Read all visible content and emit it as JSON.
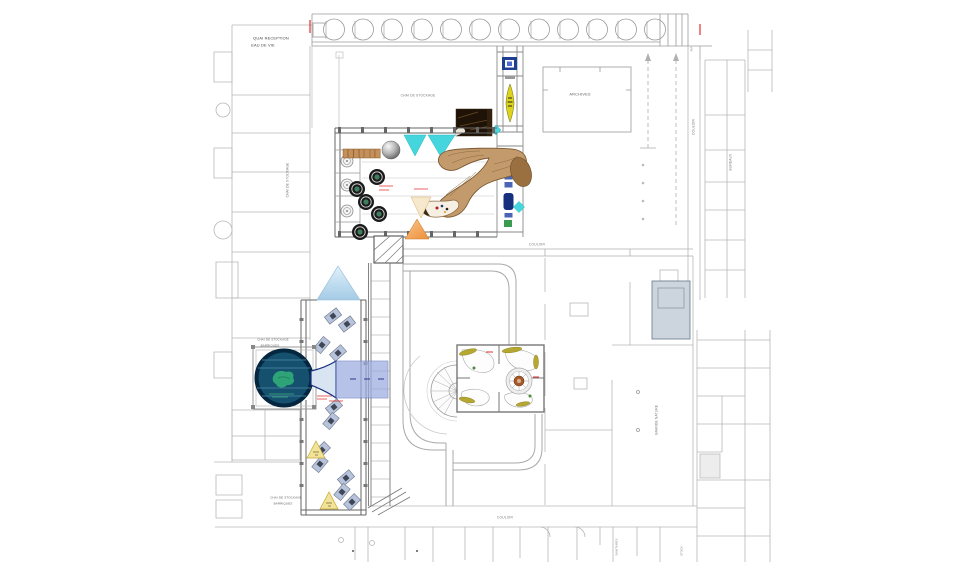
{
  "labels": {
    "quai_reception": [
      "QUAI RECEPTION",
      "EAU DE VIE"
    ],
    "chai_stockage_hall": "CHAI DE STOCKAGE",
    "archives": "ARCHIVES",
    "couloir_upper": "COULOIR",
    "couloir_right": "COULOIR",
    "couloir_bottom": "COULOIR",
    "bureaux": "BUREAUX",
    "chai_stockage_wall": "CHAI DE STOCKAGE",
    "pool_room": [
      "CHAI DE STOCKAGE",
      "BARRIQUES"
    ],
    "barrel_hall": [
      "CHAI DE STOCKAGE",
      "BARRIQUES"
    ],
    "grande_nature": "GRANDE NATURE",
    "ria": "RIA",
    "sanitaires": "SANITAIRES",
    "stock": "STOCK"
  },
  "colors": {
    "line_faint": "#b6b6b6",
    "line_medium": "#8a8a8a",
    "wall_dark": "#5f5f5f",
    "cyan": "#45d6dd",
    "sky_top": "#dff0fa",
    "sky_bottom": "#a4cbe6",
    "navy": "#1f3f93",
    "periwinkle": "#9aabe0",
    "pool_fill": "#15506f",
    "pool_rim": "#04263e",
    "pool_line": "#3f7a99",
    "green_blob": "#2fa878",
    "ribbon_brown": "#c39a6b",
    "ribbon_edge": "#7c5a33",
    "ribbon_dark": "#9a7040",
    "barrel_brown": "#c48f58",
    "tank_dark": "#1a1a1a",
    "tank_green": "#3f7f5f",
    "orange_light": "#f7c58a",
    "orange_deep": "#ee8f3a",
    "sand": "#f6e8cc",
    "yellow_tri": "#f2e39b",
    "lens_yellow": "#ded31c",
    "case_blue": "#b7c3da",
    "case_dark": "#3f4656",
    "red": "#e03030",
    "block_gray": "#ccd5dd",
    "mural_dark": "#1e1306"
  }
}
